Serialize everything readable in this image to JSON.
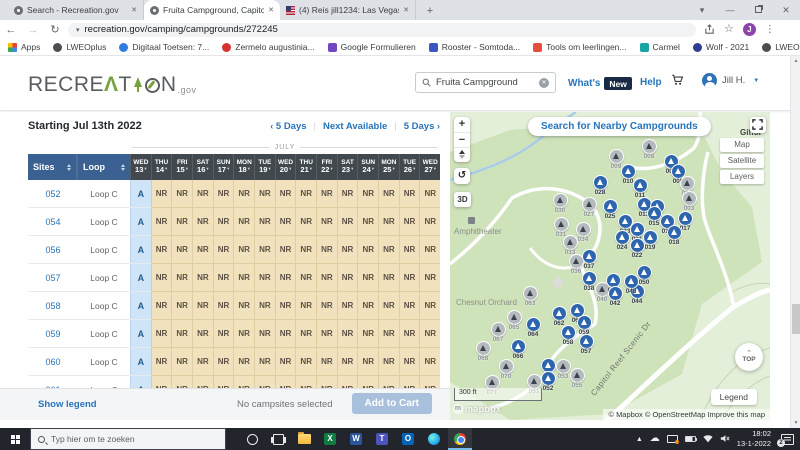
{
  "colors": {
    "header_blue": "#3a6191",
    "date_header_dark": "#42494e",
    "available_cell_bg": "#cfe4f6",
    "available_text": "#1f5b8e",
    "not_reservable_bg": "#f1e1bd",
    "not_reservable_text": "#5c5244",
    "link_blue": "#2874ba",
    "logo_green": "#76a23e",
    "new_badge_bg": "#1a2b45",
    "add_to_cart_bg": "#a9c0dc",
    "marker_available": "#2d66ae",
    "marker_unavailable": "#b5babe",
    "map_green": "#cfe3bb"
  },
  "browser": {
    "tabs": [
      {
        "title": "Search - Recreation.gov",
        "favicon": "recreation-favicon",
        "active": false
      },
      {
        "title": "Fruita Campground, Capitol Reef",
        "favicon": "recreation-favicon",
        "active": true
      },
      {
        "title": "(4) Reis jill1234: Las Vegas- Denv",
        "favicon": "us-flag-favicon",
        "active": false
      }
    ],
    "new_tab_label": "+",
    "url": "recreation.gov/camping/campgrounds/272245",
    "profile_initial": "J",
    "bookmarks": [
      {
        "label": "Apps",
        "icon": "apps-grid-icon",
        "color": "",
        "shape": "grid"
      },
      {
        "label": "LWEOplus",
        "icon": "globe-icon",
        "color": "#4a4d52",
        "shape": "circle"
      },
      {
        "label": "Digitaal Toetsen: 7...",
        "icon": "site-icon",
        "color": "#2f7de1",
        "shape": "circle"
      },
      {
        "label": "Zermelo augustinia...",
        "icon": "site-icon",
        "color": "#d63031",
        "shape": "circle"
      },
      {
        "label": "Google Formulieren",
        "icon": "forms-icon",
        "color": "#7347c1",
        "shape": "square"
      },
      {
        "label": "Rooster - Somtoda...",
        "icon": "site-icon",
        "color": "#3b55c4",
        "shape": "square"
      },
      {
        "label": "Tools om leerlingen...",
        "icon": "site-icon",
        "color": "#e74c3c",
        "shape": "square"
      },
      {
        "label": "Carmel",
        "icon": "site-icon",
        "color": "#16a5a3",
        "shape": "square"
      },
      {
        "label": "Wolf - 2021",
        "icon": "site-icon",
        "color": "#2c3e8f",
        "shape": "circle"
      },
      {
        "label": "LWEO Economie",
        "icon": "globe-icon",
        "color": "#4a4d52",
        "shape": "circle"
      }
    ],
    "bookmarks_overflow": "»",
    "reading_list_label": "Leeslijst"
  },
  "site_header": {
    "logo_seg1": "RECRE",
    "logo_a": "Λ",
    "logo_seg2": "T",
    "logo_seg3": "N",
    "logo_tld": ".gov",
    "search_value": "Fruita Campground",
    "whats_label": "What's",
    "new_badge": "New",
    "help_label": "Help",
    "user_name": "Jill H."
  },
  "availability": {
    "title": "Starting Jul 13th 2022",
    "nav": {
      "prev_chev": "‹",
      "prev_label": "5 Days",
      "next_available_label": "Next Available",
      "next_label": "5 Days",
      "next_chev": "›",
      "separator": "|"
    },
    "month_label": "JULY",
    "sites_header": "Sites",
    "loop_header": "Loop",
    "dates": [
      {
        "day": "WED",
        "date": "13"
      },
      {
        "day": "THU",
        "date": "14"
      },
      {
        "day": "FRI",
        "date": "15"
      },
      {
        "day": "SAT",
        "date": "16"
      },
      {
        "day": "SUN",
        "date": "17"
      },
      {
        "day": "MON",
        "date": "18"
      },
      {
        "day": "TUE",
        "date": "19"
      },
      {
        "day": "WED",
        "date": "20"
      },
      {
        "day": "THU",
        "date": "21"
      },
      {
        "day": "FRI",
        "date": "22"
      },
      {
        "day": "SAT",
        "date": "23"
      },
      {
        "day": "SUN",
        "date": "24"
      },
      {
        "day": "MON",
        "date": "25"
      },
      {
        "day": "TUE",
        "date": "26"
      },
      {
        "day": "WED",
        "date": "27"
      }
    ],
    "rows": [
      {
        "site": "052",
        "loop": "Loop C",
        "cells": [
          "A",
          "NR",
          "NR",
          "NR",
          "NR",
          "NR",
          "NR",
          "NR",
          "NR",
          "NR",
          "NR",
          "NR",
          "NR",
          "NR",
          "NR"
        ]
      },
      {
        "site": "054",
        "loop": "Loop C",
        "cells": [
          "A",
          "NR",
          "NR",
          "NR",
          "NR",
          "NR",
          "NR",
          "NR",
          "NR",
          "NR",
          "NR",
          "NR",
          "NR",
          "NR",
          "NR"
        ]
      },
      {
        "site": "056",
        "loop": "Loop C",
        "cells": [
          "A",
          "NR",
          "NR",
          "NR",
          "NR",
          "NR",
          "NR",
          "NR",
          "NR",
          "NR",
          "NR",
          "NR",
          "NR",
          "NR",
          "NR"
        ]
      },
      {
        "site": "057",
        "loop": "Loop C",
        "cells": [
          "A",
          "NR",
          "NR",
          "NR",
          "NR",
          "NR",
          "NR",
          "NR",
          "NR",
          "NR",
          "NR",
          "NR",
          "NR",
          "NR",
          "NR"
        ]
      },
      {
        "site": "058",
        "loop": "Loop C",
        "cells": [
          "A",
          "NR",
          "NR",
          "NR",
          "NR",
          "NR",
          "NR",
          "NR",
          "NR",
          "NR",
          "NR",
          "NR",
          "NR",
          "NR",
          "NR"
        ]
      },
      {
        "site": "059",
        "loop": "Loop C",
        "cells": [
          "A",
          "NR",
          "NR",
          "NR",
          "NR",
          "NR",
          "NR",
          "NR",
          "NR",
          "NR",
          "NR",
          "NR",
          "NR",
          "NR",
          "NR"
        ]
      },
      {
        "site": "060",
        "loop": "Loop C",
        "cells": [
          "A",
          "NR",
          "NR",
          "NR",
          "NR",
          "NR",
          "NR",
          "NR",
          "NR",
          "NR",
          "NR",
          "NR",
          "NR",
          "NR",
          "NR"
        ]
      },
      {
        "site": "061",
        "loop": "Loop C",
        "cells": [
          "A",
          "NR",
          "NR",
          "NR",
          "NR",
          "NR",
          "NR",
          "NR",
          "NR",
          "NR",
          "NR",
          "NR",
          "NR",
          "NR",
          "NR"
        ]
      }
    ]
  },
  "footer_bar": {
    "show_legend": "Show legend",
    "selection_status": "No campsites selected",
    "add_to_cart": "Add to Cart"
  },
  "map": {
    "search_nearby": "Search for Nearby Campgrounds",
    "zoom_in": "+",
    "zoom_out": "−",
    "three_d": "3D",
    "rotate_glyph": "↺",
    "style_options": [
      "Map",
      "Satellite",
      "Layers"
    ],
    "place_labels": [
      {
        "text": "Giffor",
        "x": 290,
        "y": 16,
        "cls": "dark"
      },
      {
        "text": "Amphitheater",
        "x": 4,
        "y": 115,
        "cls": ""
      },
      {
        "text": "Chesnut Orchard",
        "x": 6,
        "y": 186,
        "cls": ""
      },
      {
        "text": "Capitol Reef Scenic Dr",
        "x": 125,
        "y": 242,
        "cls": "road",
        "rotate": -52
      }
    ],
    "markers": [
      {
        "id": "008",
        "x": 200,
        "y": 35,
        "available": false
      },
      {
        "id": "006",
        "x": 222,
        "y": 50,
        "available": true
      },
      {
        "id": "009",
        "x": 167,
        "y": 45,
        "available": false
      },
      {
        "id": "010",
        "x": 179,
        "y": 60,
        "available": true
      },
      {
        "id": "005",
        "x": 229,
        "y": 60,
        "available": true
      },
      {
        "id": "011",
        "x": 191,
        "y": 74,
        "available": true
      },
      {
        "id": "004",
        "x": 238,
        "y": 72,
        "available": false
      },
      {
        "id": "003",
        "x": 240,
        "y": 87,
        "available": false
      },
      {
        "id": "013",
        "x": 195,
        "y": 93,
        "available": true
      },
      {
        "id": "014",
        "x": 208,
        "y": 95,
        "available": true
      },
      {
        "id": "028",
        "x": 151,
        "y": 71,
        "available": true
      },
      {
        "id": "025",
        "x": 161,
        "y": 95,
        "available": true
      },
      {
        "id": "030",
        "x": 111,
        "y": 89,
        "available": false
      },
      {
        "id": "027",
        "x": 140,
        "y": 93,
        "available": false
      },
      {
        "id": "015",
        "x": 205,
        "y": 102,
        "available": true
      },
      {
        "id": "016",
        "x": 218,
        "y": 110,
        "available": true
      },
      {
        "id": "017",
        "x": 236,
        "y": 107,
        "available": true
      },
      {
        "id": "023",
        "x": 176,
        "y": 110,
        "available": true
      },
      {
        "id": "021",
        "x": 188,
        "y": 118,
        "available": true
      },
      {
        "id": "024",
        "x": 173,
        "y": 126,
        "available": true
      },
      {
        "id": "019",
        "x": 201,
        "y": 126,
        "available": true
      },
      {
        "id": "018",
        "x": 225,
        "y": 121,
        "available": true
      },
      {
        "id": "022",
        "x": 188,
        "y": 134,
        "available": true
      },
      {
        "id": "031",
        "x": 112,
        "y": 113,
        "available": false
      },
      {
        "id": "034",
        "x": 134,
        "y": 118,
        "available": false
      },
      {
        "id": "033",
        "x": 121,
        "y": 131,
        "available": false
      },
      {
        "id": "036",
        "x": 127,
        "y": 150,
        "available": false
      },
      {
        "id": "037",
        "x": 140,
        "y": 145,
        "available": true
      },
      {
        "id": "038",
        "x": 140,
        "y": 167,
        "available": true
      },
      {
        "id": "040",
        "x": 153,
        "y": 178,
        "available": false
      },
      {
        "id": "041",
        "x": 164,
        "y": 169,
        "available": true
      },
      {
        "id": "042",
        "x": 166,
        "y": 182,
        "available": true
      },
      {
        "id": "044",
        "x": 188,
        "y": 180,
        "available": true
      },
      {
        "id": "048",
        "x": 182,
        "y": 170,
        "available": true
      },
      {
        "id": "050",
        "x": 195,
        "y": 161,
        "available": true
      },
      {
        "id": "063",
        "x": 81,
        "y": 182,
        "available": false
      },
      {
        "id": "062",
        "x": 110,
        "y": 202,
        "available": true
      },
      {
        "id": "061",
        "x": 128,
        "y": 199,
        "available": true
      },
      {
        "id": "064",
        "x": 84,
        "y": 213,
        "available": true
      },
      {
        "id": "065",
        "x": 65,
        "y": 206,
        "available": false
      },
      {
        "id": "067",
        "x": 49,
        "y": 218,
        "available": false
      },
      {
        "id": "059",
        "x": 135,
        "y": 211,
        "available": true
      },
      {
        "id": "058",
        "x": 119,
        "y": 221,
        "available": true
      },
      {
        "id": "057",
        "x": 137,
        "y": 230,
        "available": true
      },
      {
        "id": "066",
        "x": 69,
        "y": 235,
        "available": true
      },
      {
        "id": "068",
        "x": 34,
        "y": 237,
        "available": false
      },
      {
        "id": "070",
        "x": 57,
        "y": 255,
        "available": false
      },
      {
        "id": "054",
        "x": 99,
        "y": 254,
        "available": true
      },
      {
        "id": "053",
        "x": 114,
        "y": 255,
        "available": false
      },
      {
        "id": "052",
        "x": 99,
        "y": 267,
        "available": true
      },
      {
        "id": "055",
        "x": 128,
        "y": 264,
        "available": false
      },
      {
        "id": "071",
        "x": 43,
        "y": 271,
        "available": false
      },
      {
        "id": "051",
        "x": 85,
        "y": 270,
        "available": false
      }
    ],
    "scale_label": "300 ft",
    "logo_text": "mapbox",
    "attribution": "© Mapbox © OpenStreetMap Improve this map",
    "top_button": "TOP",
    "legend_button": "Legend"
  },
  "taskbar": {
    "search_placeholder": "Typ hier om te zoeken",
    "apps": [
      "cortana",
      "task-view",
      "file-explorer",
      "excel",
      "word",
      "teams",
      "outlook",
      "edge",
      "chrome"
    ],
    "app_letters": {
      "excel": "X",
      "word": "W",
      "teams": "T",
      "outlook": "O"
    },
    "app_colors": {
      "excel": "#107c41",
      "word": "#2b579a",
      "teams": "#4b53bc",
      "outlook": "#0364b8"
    },
    "clock_time": "18:02",
    "clock_date": "13-1-2022",
    "notification_count": "2"
  }
}
